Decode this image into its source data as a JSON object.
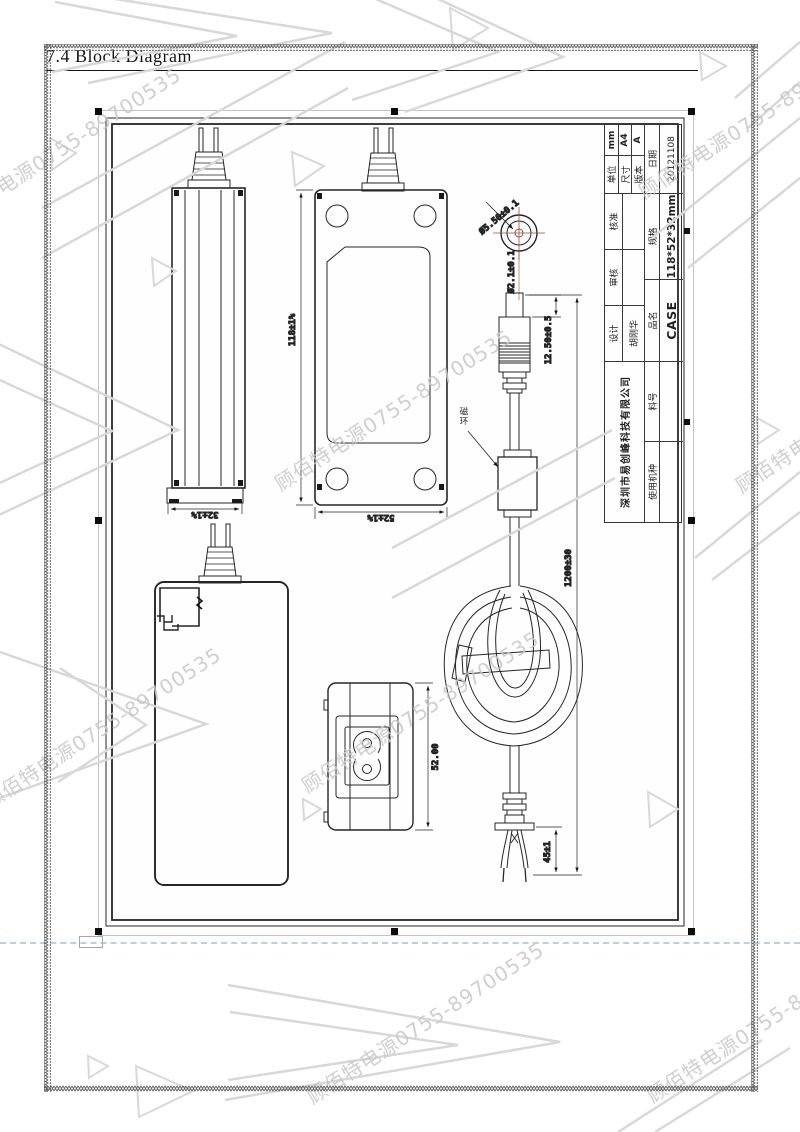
{
  "page": {
    "title": "7.4 Block Diagram"
  },
  "watermark": {
    "text": "顾佰特电源0755-89700535"
  },
  "title_block": {
    "company": "深圳市易创峰科技有限公司",
    "design_label": "设计",
    "design_value": "胡刚华",
    "review_label": "审核",
    "review_value": "",
    "approve_label": "核准",
    "approve_value": "",
    "unit_label": "单位",
    "unit_value": "mm",
    "size_label": "尺寸",
    "size_value": "A4",
    "version_label": "版本",
    "version_value": "A",
    "model_label": "使用机种",
    "model_value": "",
    "part_label": "料号",
    "part_value": "",
    "product_label": "品名",
    "product_value": "CASE",
    "spec_label": "规格",
    "spec_value": "118*52*32mm",
    "date_label": "日期",
    "date_value": "20121108"
  },
  "dimensions": {
    "case_height": "118±1%",
    "case_width": "52±1%",
    "case_depth": "32±1%",
    "inlet_height": "52.00",
    "plug_tip_length": "12.50±0.5",
    "plug_outer_dia": "Ø5.50±0.1",
    "plug_pin_dia": "Ø2.1±0.1",
    "cable_length": "1200±30",
    "wire_split_length": "45±1"
  },
  "labels": {
    "ferrite_bead": "磁环"
  },
  "colors": {
    "line": "#222222",
    "watermark_gray": "#c7c7c7",
    "shape_gray": "#d8d8d8",
    "selection_handle": "#0c0c0c",
    "guide_blue": "#b9cfe4",
    "crosshair_red": "#9a5040"
  }
}
